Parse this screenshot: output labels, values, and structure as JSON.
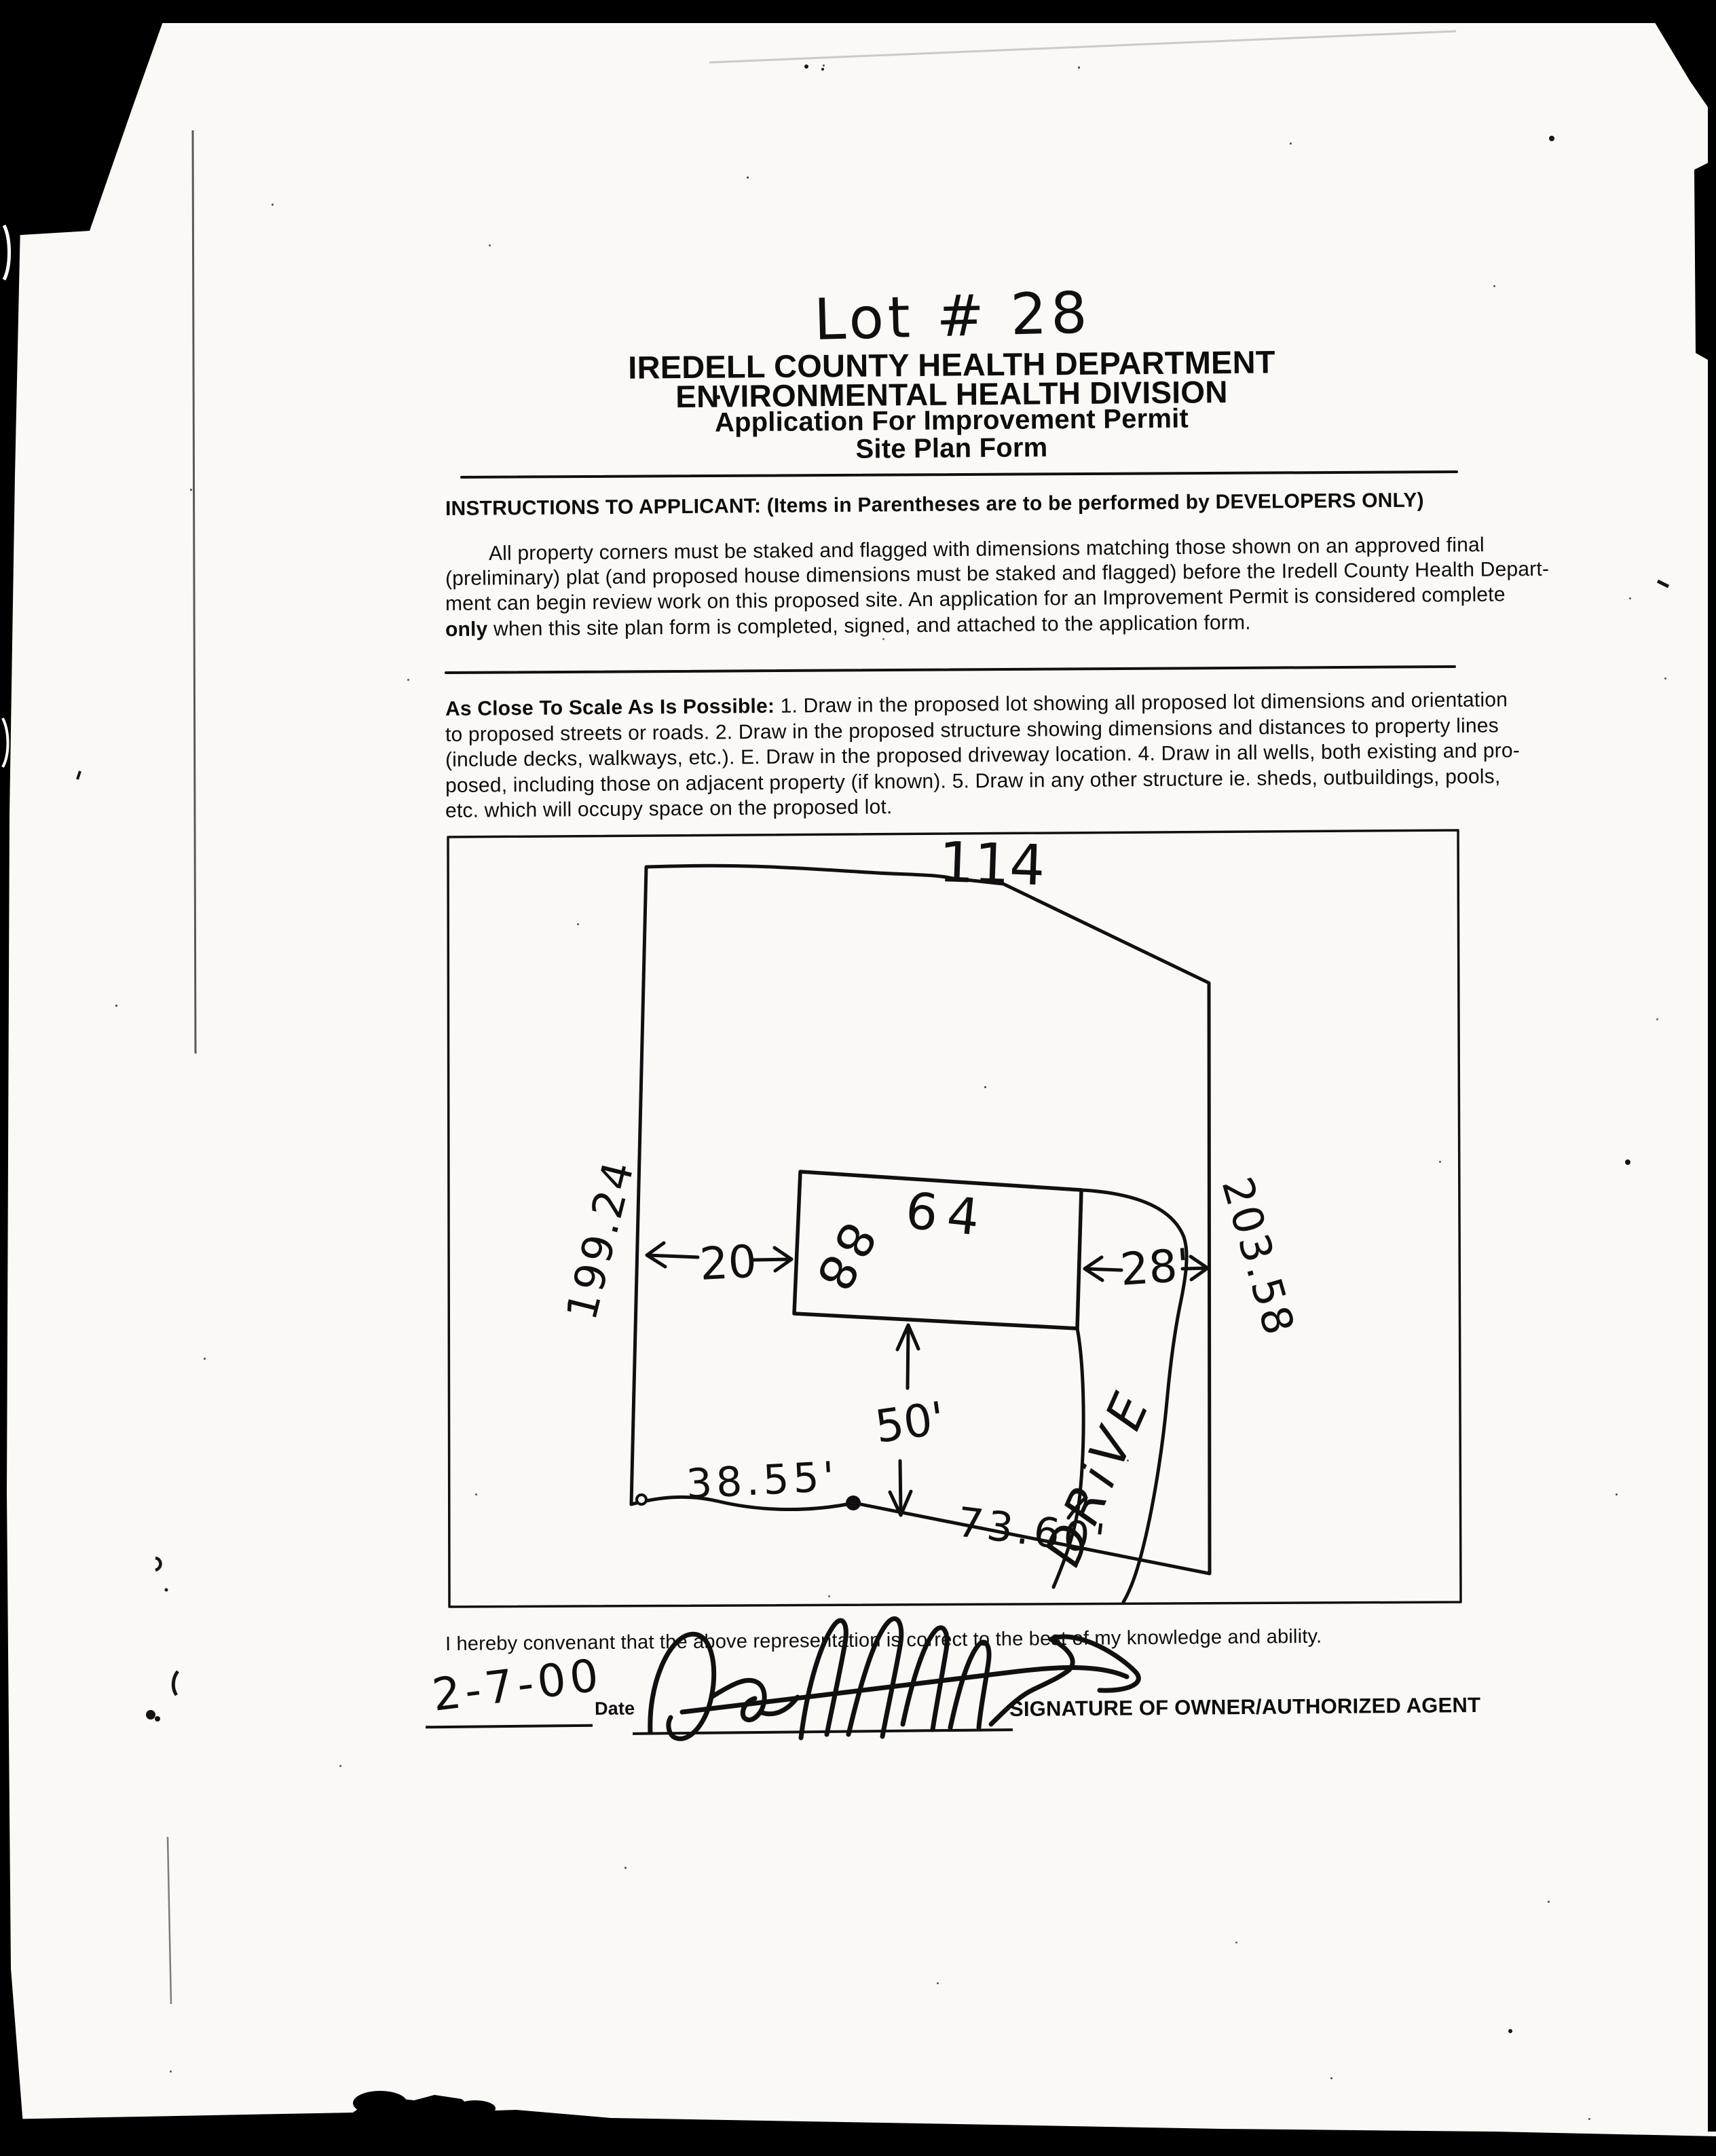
{
  "document": {
    "lot_annotation": "Lot # 28",
    "header_lines": [
      "IREDELL COUNTY HEALTH DEPARTMENT",
      "ENVIRONMENTAL HEALTH DIVISION",
      "Application For Improvement Permit",
      "Site Plan Form"
    ],
    "instructions_heading": "INSTRUCTIONS TO APPLICANT: (Items in Parentheses are to be performed by DEVELOPERS ONLY)",
    "instructions_lines": [
      "All property corners must be staked and flagged with dimensions matching those shown on an approved final",
      "(preliminary) plat (and proposed house dimensions must be staked and flagged) before the Iredell County Health Depart-",
      "ment can begin review work on this proposed site. An application for an Improvement Permit is considered complete"
    ],
    "instructions_last_bold": "only",
    "instructions_last_rest": " when this site plan form is completed, signed, and attached to the application form.",
    "scale_lead": "As Close To Scale As Is Possible:",
    "scale_line1_rest": " 1. Draw in the proposed lot showing all proposed lot dimensions and orientation",
    "scale_lines": [
      "to proposed streets or roads. 2. Draw in the proposed structure showing dimensions and distances to property lines",
      "(include decks, walkways, etc.). E. Draw in the proposed driveway location. 4. Draw in all wells, both existing and pro-",
      "posed, including those on adjacent property (if known). 5. Draw in any other structure ie. sheds, outbuildings, pools,",
      "etc. which will occupy space on the proposed lot."
    ],
    "covenant": "I hereby convenant that the above representation is correct to the best of my knowledge and ability.",
    "date_value": "2-7-00",
    "date_label": "Date",
    "signature_label": "SIGNATURE OF OWNER/AUTHORIZED AGENT"
  },
  "site_plan": {
    "lot_top": "114",
    "lot_left": "199.24",
    "lot_right": "203.58",
    "lot_bottom_left": "38.55'",
    "lot_bottom_right": "73.60'",
    "house_width": "64",
    "house_depth": "88",
    "setback_left": "20",
    "setback_right": "28'",
    "setback_front": "50'",
    "driveway_label": "DRiVE"
  }
}
